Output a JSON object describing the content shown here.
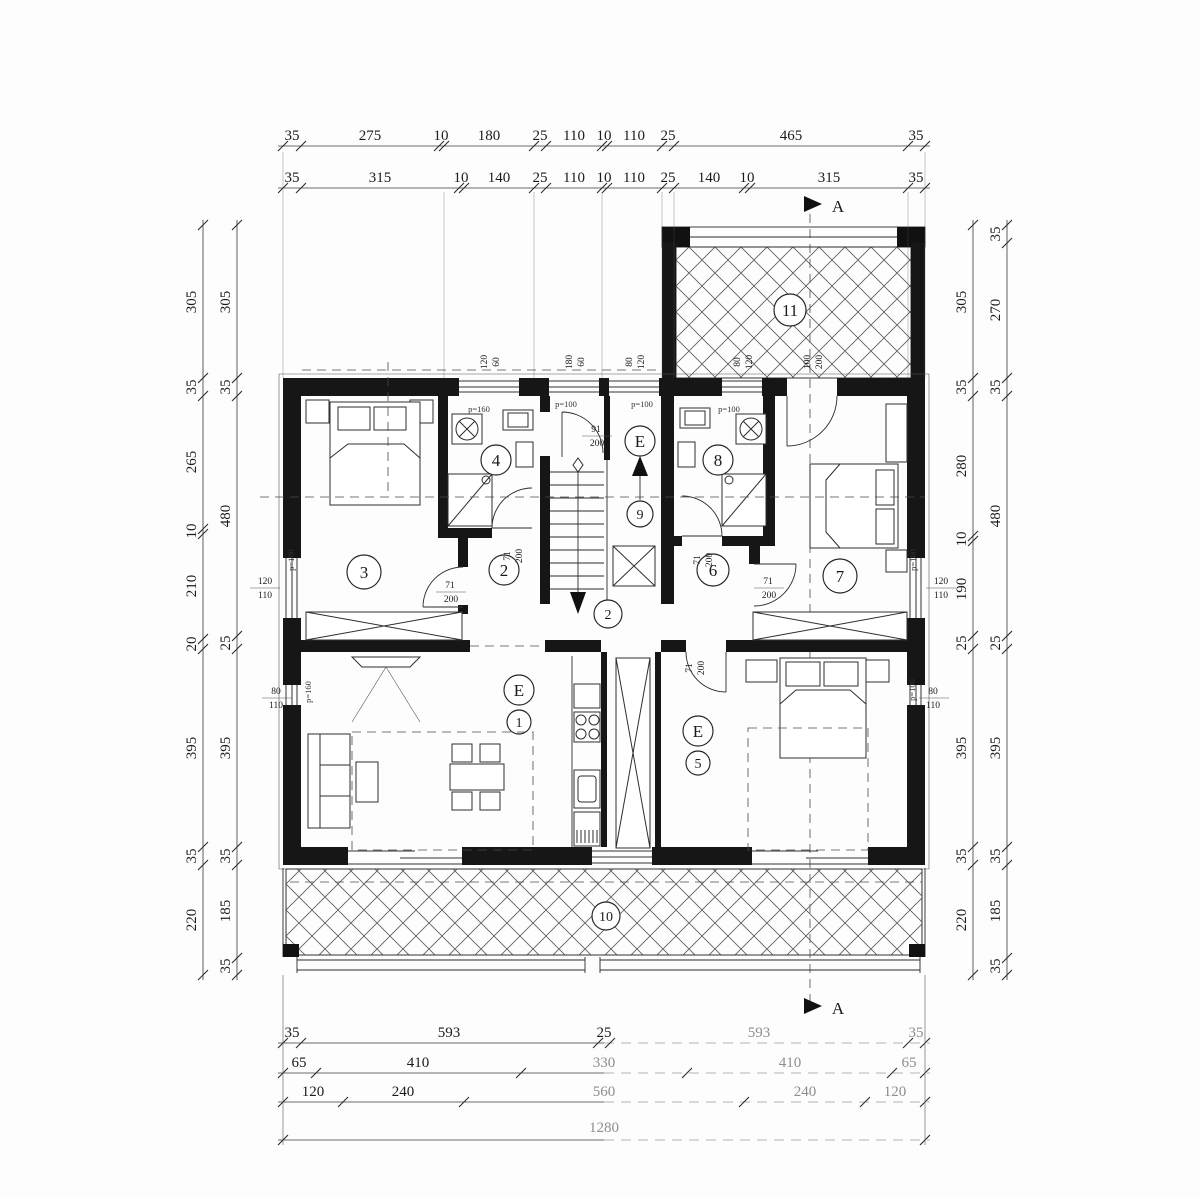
{
  "dims": {
    "top1": [
      "35",
      "275",
      "10",
      "180",
      "25",
      "110",
      "10",
      "110",
      "25",
      "465",
      "35"
    ],
    "top2": [
      "35",
      "315",
      "10",
      "140",
      "25",
      "110",
      "10",
      "110",
      "25",
      "140",
      "10",
      "315",
      "35"
    ],
    "left_outer": [
      "305",
      "35",
      "265",
      "10",
      "210",
      "20",
      "395",
      "35",
      "220"
    ],
    "left_inner": [
      "305",
      "35",
      "480",
      "25",
      "395",
      "35",
      "185",
      "35"
    ],
    "right_inner": [
      "305",
      "35",
      "280",
      "10",
      "190",
      "25",
      "395",
      "35",
      "220"
    ],
    "right_outer": [
      "35",
      "270",
      "35",
      "480",
      "25",
      "395",
      "35",
      "185",
      "35"
    ],
    "bottom1": [
      "35",
      "593",
      "25",
      "593",
      "35"
    ],
    "bottom2": [
      "65",
      "410",
      "330",
      "410",
      "65"
    ],
    "bottom3": [
      "120",
      "240",
      "560",
      "240",
      "120"
    ],
    "bottom_total": "1280"
  },
  "rooms": {
    "n1": "1",
    "n2": "2",
    "n3": "3",
    "n4": "4",
    "n5": "5",
    "n6": "6",
    "n7": "7",
    "n8": "8",
    "n9": "9",
    "n10": "10",
    "n11": "11",
    "entry": "E"
  },
  "doors": {
    "d71w": "71",
    "d71h": "200",
    "d91w": "91",
    "d91h": "200"
  },
  "windows": {
    "w120": "120",
    "w110": "110",
    "w80": "80",
    "w60": "60",
    "w180": "180",
    "w100": "100",
    "w200": "200"
  },
  "parapet": {
    "p100": "p=100",
    "p160": "p=160"
  },
  "section": {
    "marker": "A"
  }
}
